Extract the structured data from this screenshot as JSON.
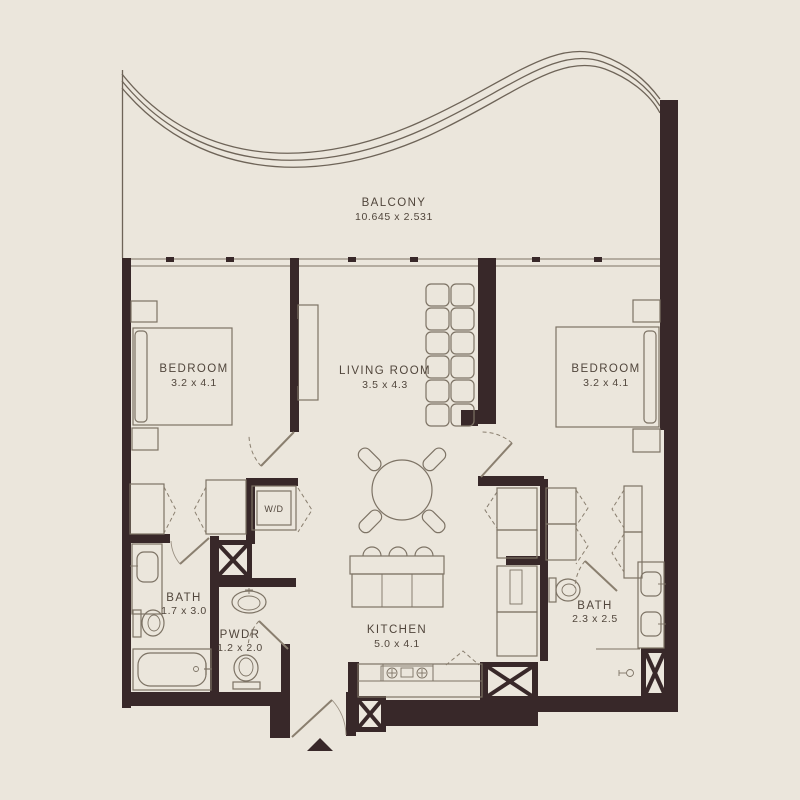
{
  "colors": {
    "background": "#ebe6dc",
    "wall": "#382829",
    "furniture_line": "#7d7365",
    "door_line": "#8a7f6f",
    "text": "#51463c"
  },
  "rooms": {
    "balcony": {
      "name": "BALCONY",
      "dims": "10.645 x 2.531"
    },
    "bedroom_left": {
      "name": "BEDROOM",
      "dims": "3.2 x 4.1"
    },
    "living_room": {
      "name": "LIVING ROOM",
      "dims": "3.5 x 4.3"
    },
    "bedroom_right": {
      "name": "BEDROOM",
      "dims": "3.2 x 4.1"
    },
    "bath_left": {
      "name": "BATH",
      "dims": "1.7 x 3.0"
    },
    "powder_room": {
      "name": "PWDR",
      "dims": "1.2 x 2.0"
    },
    "kitchen": {
      "name": "KITCHEN",
      "dims": "5.0 x 4.1"
    },
    "bath_right": {
      "name": "BATH",
      "dims": "2.3 x 2.5"
    }
  },
  "labels": {
    "washer_dryer": "W/D"
  }
}
